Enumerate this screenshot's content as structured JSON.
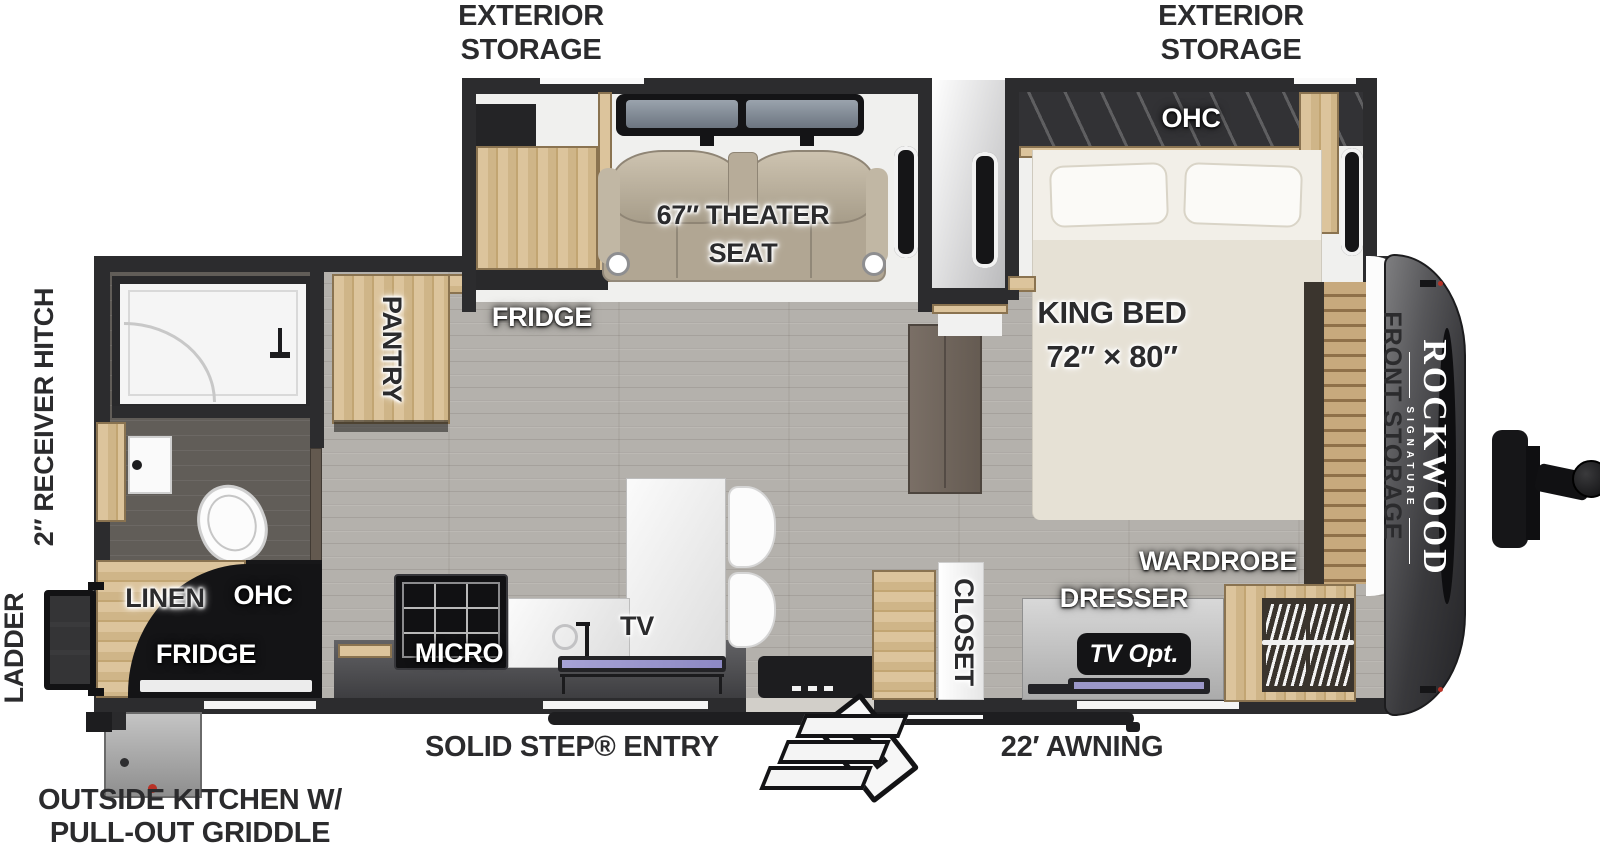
{
  "title": "Rockwood Signature travel trailer floor plan",
  "labels": {
    "ext_storage_l1": "EXTERIOR",
    "ext_storage_l2": "STORAGE",
    "receiver_hitch": "2″ RECEIVER HITCH",
    "ladder": "LADDER",
    "outside_kitchen1": "OUTSIDE KITCHEN W/",
    "outside_kitchen2": "PULL-OUT GRIDDLE",
    "solid_step": "SOLID STEP® ENTRY",
    "awning": "22′ AWNING",
    "theater1": "67″ THEATER",
    "theater2": "SEAT",
    "fridge": "FRIDGE",
    "pantry": "PANTRY",
    "ohc": "OHC",
    "king1": "KING BED",
    "king2": "72″ × 80″",
    "front_storage": "FRONT STORAGE",
    "wardrobe": "WARDROBE",
    "dresser": "DRESSER",
    "tv_opt": "TV Opt.",
    "closet": "CLOSET",
    "linen": "LINEN",
    "micro": "MICRO",
    "tv": "TV",
    "brand": "ROCKWOOD",
    "brand_sub": "SIGNATURE"
  },
  "colors": {
    "wall": "#2c2c2e",
    "floor_main": "#b4b1ac",
    "floor_bath": "#615d58",
    "wood": "#d2b astro",
    "wood_light": "#dcc49c",
    "theater_seat": "#b1a693",
    "mattress": "#ece8dd",
    "front_cap": "#39393c",
    "tv_screen": "#9b97c9",
    "badge": "#141416",
    "red_dot": "#b83227"
  }
}
